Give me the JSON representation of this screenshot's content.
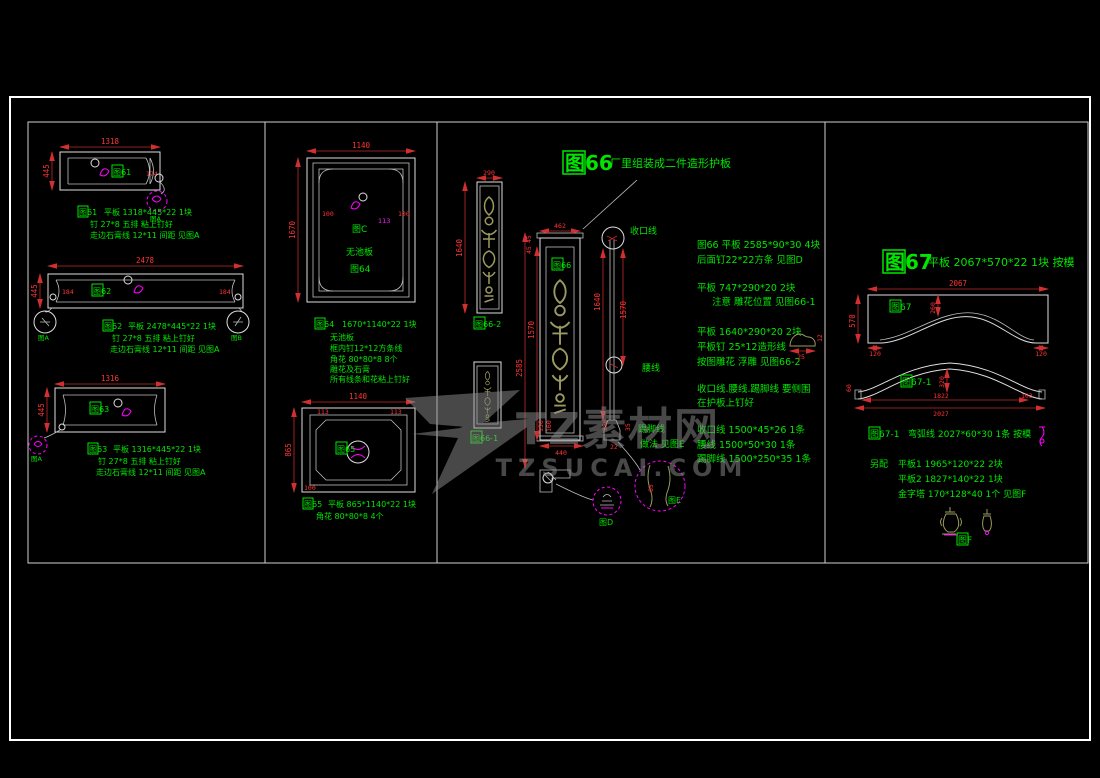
{
  "colors": {
    "background": "#000000",
    "line": "#e8e8e8",
    "dimension": "#ff3434",
    "annotation": "#00e600",
    "detail": "#ff00ff",
    "carving": "#9a9a5e",
    "watermark": "#8f8f8f"
  },
  "watermark": {
    "brand": "TZ素材网",
    "domain": "TZSUCAI.COM"
  },
  "fig61": {
    "label": "图61",
    "dims": {
      "width": "1318",
      "height": "445",
      "end": "174"
    },
    "detail_tag": "图A",
    "note_tag": "图61",
    "notes": [
      "平板 1318*445*22 1块",
      "钉 27*8 五排 粘上钉好",
      "走边石膏线 12*11 间距 见图A"
    ]
  },
  "fig62": {
    "label": "图62",
    "dims": {
      "width": "2478",
      "height": "445",
      "end_left": "184",
      "end_right": "184"
    },
    "detail_left": "图A",
    "detail_right": "图B",
    "note_tag": "图62",
    "notes": [
      "平板 2478*445*22 1块",
      "钉 27*8 五排 粘上钉好",
      "走边石膏线 12*11 间距 见图A"
    ]
  },
  "fig63": {
    "label": "图63",
    "dims": {
      "width": "1316",
      "height": "445"
    },
    "detail_tag": "图A",
    "note_tag": "图63",
    "notes": [
      "平板 1316*445*22 1块",
      "钉 27*8 五排 粘上钉好",
      "走边石膏线 12*11 间距 见图A"
    ]
  },
  "fig64": {
    "inner_labels": [
      "图C",
      "无池板",
      "图64"
    ],
    "dims": {
      "width": "1140",
      "height": "1670",
      "corner_left": "100",
      "corner_right": "100",
      "ornament": "113"
    },
    "note_tag": "图64",
    "notes": [
      "1670*1140*22 1块",
      "无池板",
      "框内钉12*12方条线",
      "角花 80*80*8 8个",
      "雕花及石膏",
      "所有线条和花粘上钉好"
    ]
  },
  "fig65": {
    "label": "图65",
    "dims": {
      "width": "1140",
      "height": "865",
      "corner_left": "113",
      "corner_right": "113",
      "side": "100"
    },
    "note_tag": "图65",
    "notes": [
      "平板 865*1140*22 1块",
      "角花 80*80*8 4个"
    ]
  },
  "fig66": {
    "title_tag": "图66",
    "title_text": "厂里组装成二件造形护板",
    "panel_a": {
      "label": "图66-2",
      "dim_width": "290",
      "dim_height": "1640"
    },
    "panel_b": {
      "label": "图66-1"
    },
    "panel_mid": {
      "label": "图66",
      "dim_width": "462",
      "dim_top1": "45",
      "dim_top2": "45",
      "dim_inner": "1570",
      "dim_outer": "2585",
      "dim_bottom_w": "440",
      "dim_h1": "150",
      "dim_h2": "160"
    },
    "profile": {
      "label_top": "收口线",
      "label_mid": "腰线",
      "label_bottom": "踢脚线",
      "method": "做法 见图E",
      "dim_left": "1640",
      "dim_right": "1570",
      "dim_sk_h": "250",
      "dim_sk_w": "35",
      "dim_sk_t": "22"
    },
    "sketch": {
      "dim_w": "25",
      "dim_h": "12"
    },
    "details": {
      "d": "图D",
      "e": "图E",
      "e_dim": "65"
    },
    "notes1": [
      "图66 平板  2585*90*30 4块",
      "后面钉22*22方条 见图D"
    ],
    "notes2": [
      "平板 747*290*20 2块",
      "注意 雕花位置 见图66-1"
    ],
    "notes3": [
      "平板 1640*290*20 2块",
      "平板钉 25*12造形线",
      "按图雕花 浮雕 见图66-2"
    ],
    "notes4": [
      "收口线.腰线.踢脚线 要侧围",
      "在护板上钉好"
    ],
    "notes5": [
      "收口线 1500*45*26 1条",
      "腰线 1500*50*30 1条",
      "踢脚线 1500*250*35 1条"
    ]
  },
  "fig67": {
    "title_tag": "图67",
    "title_text": "平板 2067*570*22 1块 按模",
    "shape1": {
      "label": "图67",
      "dim_top": "2067",
      "dim_left": "570",
      "dim_mid": "260",
      "dim_bl": "120",
      "dim_br": "120"
    },
    "shape2": {
      "label": "图67-1",
      "dim_mid": "320",
      "dim_inner": "1822",
      "dim_bottom": "2027",
      "dim_left": "60",
      "dim_right": "103"
    },
    "note_tag": "图67-1",
    "note_text": "弯弧线 2027*60*30 1条 按模",
    "extra_title": "另配",
    "extra": [
      "平板1  1965*120*22 2块",
      "平板2  1827*140*22 1块",
      "金字塔 170*128*40 1个 见图F"
    ],
    "detail_f": "图F"
  }
}
